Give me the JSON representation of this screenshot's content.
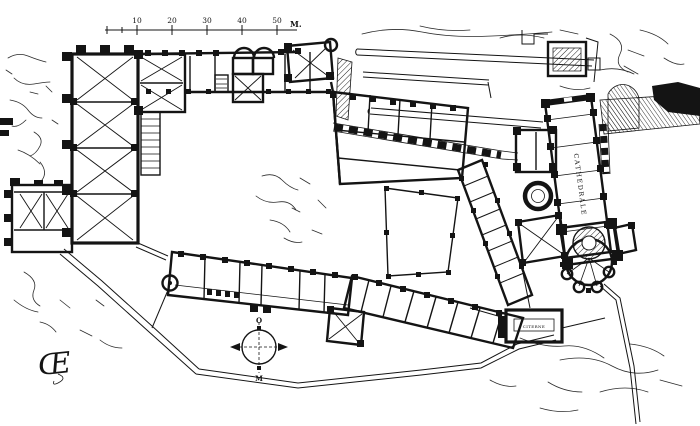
{
  "figure": {
    "kind": "engraved-floor-plan",
    "scale_bar": {
      "ticks": [
        "10",
        "20",
        "30",
        "40",
        "50"
      ],
      "unit": "M."
    },
    "labels": {
      "cathedral": "CATHEDRALE",
      "cistern": "CITERNE"
    },
    "compass": {
      "top_label": "O",
      "bottom_label": "M"
    },
    "monogram": "Œ",
    "colors": {
      "ink": "#141414",
      "paper": "#ffffff"
    }
  }
}
